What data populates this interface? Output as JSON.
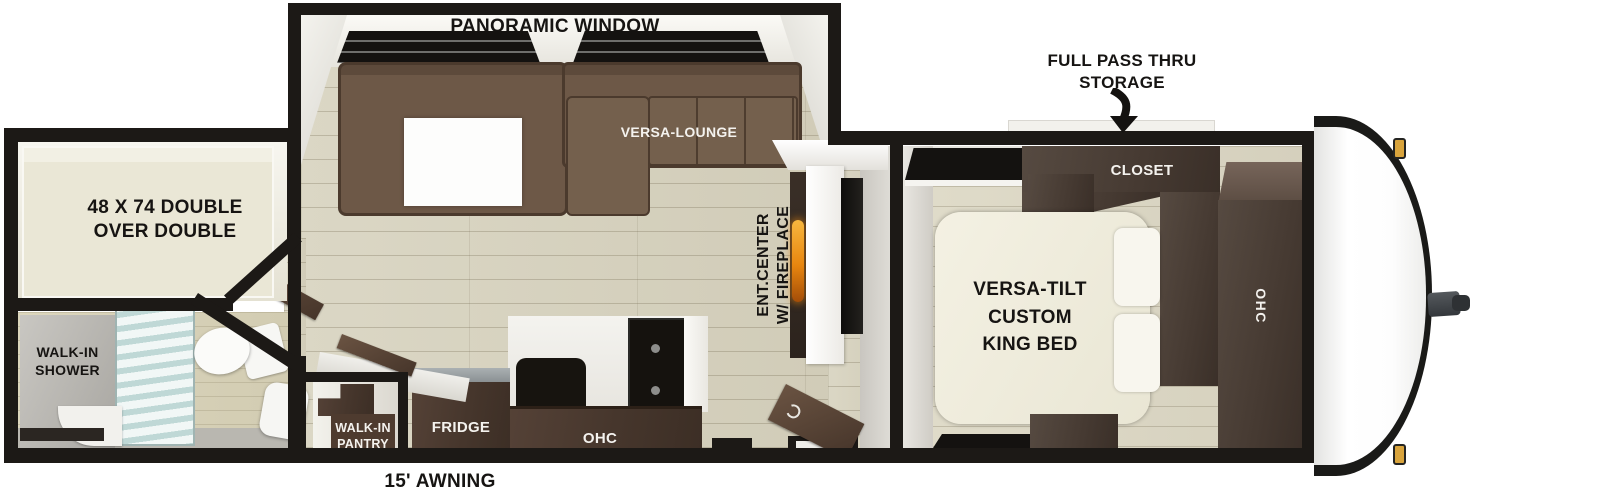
{
  "title": "Travel trailer floor plan",
  "labels": {
    "panoramic_window": "PANORAMIC WINDOW",
    "versa_lounge": "VERSA-LOUNGE",
    "full_pass_thru": [
      "FULL PASS THRU",
      "STORAGE"
    ],
    "closet": "CLOSET",
    "king_bed": [
      "VERSA-TILT",
      "CUSTOM",
      "KING BED"
    ],
    "bedroom_ohc": "OHC",
    "bunk": [
      "48 X 74 DOUBLE",
      "OVER DOUBLE"
    ],
    "shower": [
      "WALK-IN",
      "SHOWER"
    ],
    "pantry": [
      "WALK-IN",
      "PANTRY"
    ],
    "fridge": "FRIDGE",
    "kitchen_ohc": "OHC",
    "ent_center": [
      "ENT.CENTER",
      "W/ FIREPLACE"
    ],
    "awning": "15' AWNING"
  },
  "colors": {
    "wall": "#1c1916",
    "floor": "#d8d4c1",
    "sofa_brown": "#6a5645",
    "cabinet_walnut": "#4e3c2f",
    "bedroom_cabinet": "#473a31",
    "bed_cream": "#efecdc",
    "fireplace_flame": "#e8860f",
    "marker_light": "#d9a43c",
    "shower_glass": "#cfe2e0"
  }
}
